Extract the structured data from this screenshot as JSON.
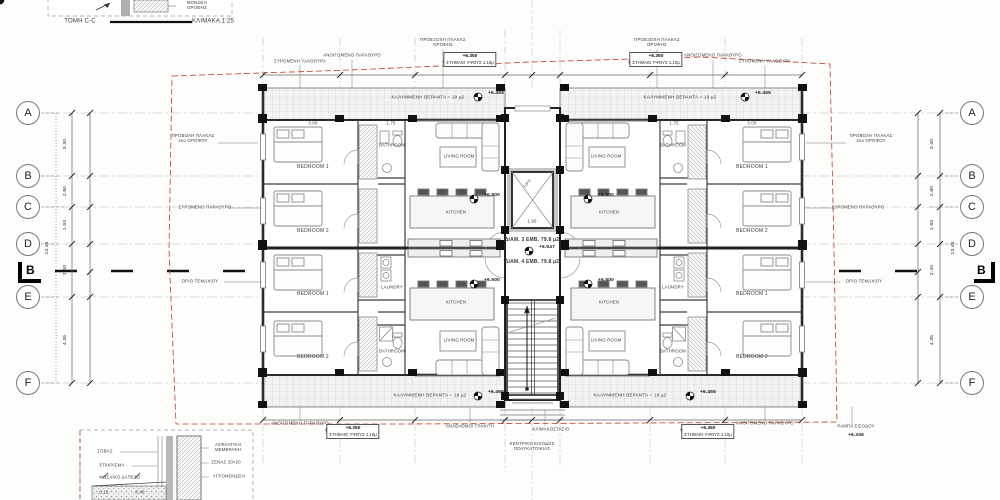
{
  "drawing": {
    "section_detail": {
      "title": "ΤΟΜΗ C-C",
      "scale": "ΚΛΙΜΑΚΑ 1:25",
      "note": "ΜΟΝΩΣΗ ΟΡΟΦΗΣ"
    },
    "corner_detail": {
      "labels_left": [
        "ΣΟΒΑΣ",
        "ΕΠΙΧΡΙΣΜΑ",
        "ΜΩΣΑΪΚΟ ΔΑΠΕΔΟ",
        "0.15",
        "0.40"
      ],
      "labels_right": [
        "ΑΣΦΑΛΤΙΚΗ ΜΕΜΒΡΑΝΗ",
        "ΣΕΝΑΖ 20×20",
        "ΥΓΡΟΜΟΝΩΣΗ"
      ]
    }
  },
  "grid": {
    "rows": [
      "A",
      "B",
      "C",
      "D",
      "E",
      "F"
    ],
    "dims": [
      "3.30",
      "2.80",
      "1.93",
      "2.40",
      "4.35"
    ],
    "total": "13.45",
    "section_marker": "B"
  },
  "rooms": {
    "bedroom1": "BEDROOM 1",
    "bedroom2": "BEDROOM 2",
    "living": "LIVING ROOM",
    "kitchen": "KITCHEN",
    "bathroom": "BATHROOM",
    "laundry": "LAUNDRY",
    "lift": "LIFT"
  },
  "veranda": {
    "label": "ΚΑΛΥΜΜΕΝΗ ΒΕΡΑΝΤΑ = 19 μ2",
    "level": "+6.455"
  },
  "levels": {
    "living": "+6.500",
    "landing": "+6.547",
    "parapet": "+6.350",
    "entrance": "+6.345"
  },
  "apartments": {
    "apt1": "ΔΙΑΜ. 3  ΕΜΒ. 79.8 μ2",
    "apt2": "ΔΙΑΜ. 4  ΕΜΒ. 79.8 μ2"
  },
  "dims_inline": {
    "bedroom": "3.00",
    "bath": "1.75",
    "lift": "1.90"
  },
  "annotations": {
    "sliding_door": "ΣΥΡΟΜΕΝΗ ΥΑΛΟΘΥΡΑ",
    "window": "ΑΝΟΙΓΟΜΕΝΟ ΠΑΡΑΘΥΡΟ",
    "roof_overhang": "ΠΡΟΕΞΟΧΗ ΠΛΑΚΑΣ ΟΡΟΦΗΣ",
    "parapet": "ΣΤΗΘΑΙΟ ΥΨΟΥΣ 1.10μ",
    "slab_projection": "ΠΡΟΒΟΛΗ ΠΛΑΚΑΣ 2ου ΟΡΟΦΟΥ",
    "sliding_window": "ΣΥΡΟΜΕΝΟ ΠΑΡΑΘΥΡΟ",
    "plot_boundary": "ΟΡΙΟ ΤΕΜΑΧΙΟΥ",
    "granite_steps": "ΑΝΑΒΑΘΜΟΙ ΓΡΑΝΙΤΗ",
    "stair_core": "ΚΛΙΜΑΚΟΣΤΑΣΙΟ",
    "entrance": "ΚΕΝΤΡΙΚΗ ΕΙΣΟΔΟΣ ΠΟΛΥΚΑΤΟΙΚΙΑΣ",
    "ramp": "ΡΑΜΠΑ ΕΙΣΟΔΟΥ"
  },
  "colors": {
    "boundary_red": "#c0392b",
    "line_dark": "#222",
    "hatch": "#c9c9c9"
  }
}
